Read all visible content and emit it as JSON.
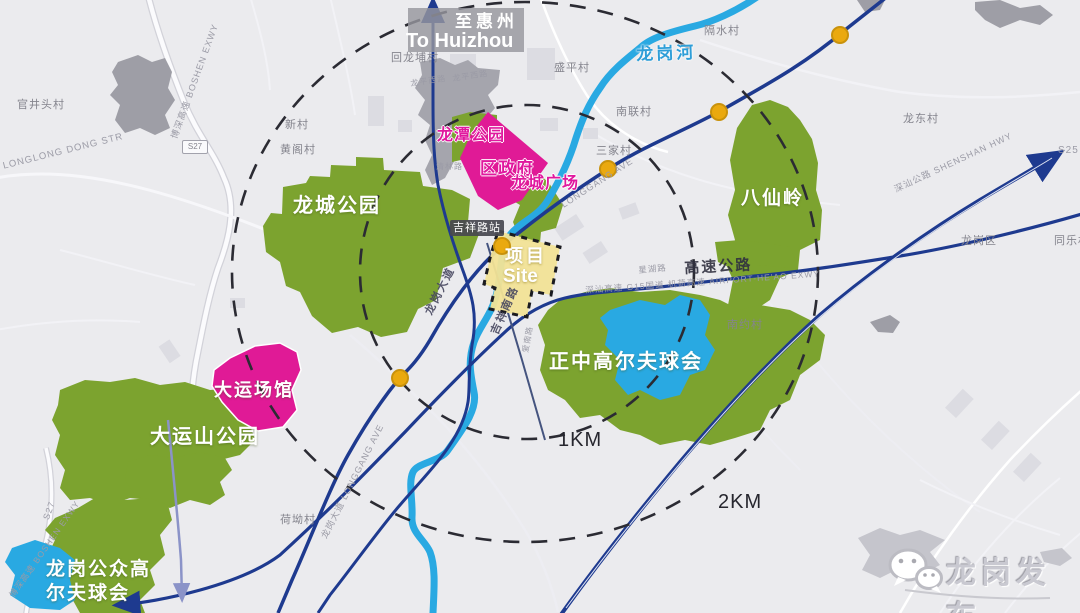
{
  "sign_to_huizhou": {
    "cn": "至惠州",
    "en": "To Huizhou"
  },
  "station": {
    "name": "吉祥路站"
  },
  "site": {
    "cn": "项目",
    "en": "Site"
  },
  "rings": {
    "inner": "1KM",
    "outer": "2KM"
  },
  "river": {
    "name": "龙岗河"
  },
  "areas": {
    "longcheng_park": "龙城公园",
    "longtan_park": "龙潭公园",
    "district_government": "区政府",
    "longcheng_square": "龙城广场",
    "baxianling": "八仙岭",
    "zhengzhong_golf": "正中高尔夫球会",
    "dayun_venues": "大运场馆",
    "dayunshan_park": "大运山公园",
    "public_golf_line1": "龙岗公众高",
    "public_golf_line2": "尔夫球会"
  },
  "villages": {
    "guanjingtou": "官井头村",
    "xincun": "新村",
    "huangge": "黄阁村",
    "huilongpu": "回龙埔村",
    "shengping": "盛平村",
    "nanlian": "南联村",
    "sanjia": "三家村",
    "geshui": "隔水村",
    "longdong": "龙东村",
    "nanyue": "南约村",
    "heao": "荷坳村",
    "longgang_district": "龙岗区",
    "tongle": "同乐村"
  },
  "roads": {
    "expressway": "高速公路",
    "expressway_detail": "深汕高速 G15国道 机荷高速 AIRPORT-HE'AO EXWY",
    "longgang_ave_cn": "龙岗大道",
    "jixiang_south_rd": "吉祥南路",
    "longgang_ave_en": "LONGGANG AVE",
    "longgang_ave_full": "龙岗大道 LONGGANG AVE",
    "shenshan_hwy": "深汕公路 SHENSHAN HWY",
    "boshen_exwy": "博深高速 BOSHEN EXWY",
    "s27": "S27",
    "s25": "S25",
    "longlong_dong_str": "LONGLONG DONG STR",
    "xinghu_rd": "星湖路",
    "longping_west_rd": "龙平西路",
    "qinglin_rd": "清林路",
    "ainan_rd": "爱南路"
  },
  "watermark": {
    "text": "龙岗发布"
  },
  "colors": {
    "park_green": "#7ca32f",
    "magenta_area": "#e01a96",
    "magenta_text": "#e0189e",
    "river_blue": "#29a9e2",
    "road_navy": "#1e3a8f",
    "site_yellow": "#f2e396",
    "station_dot": "#eaa90f"
  }
}
